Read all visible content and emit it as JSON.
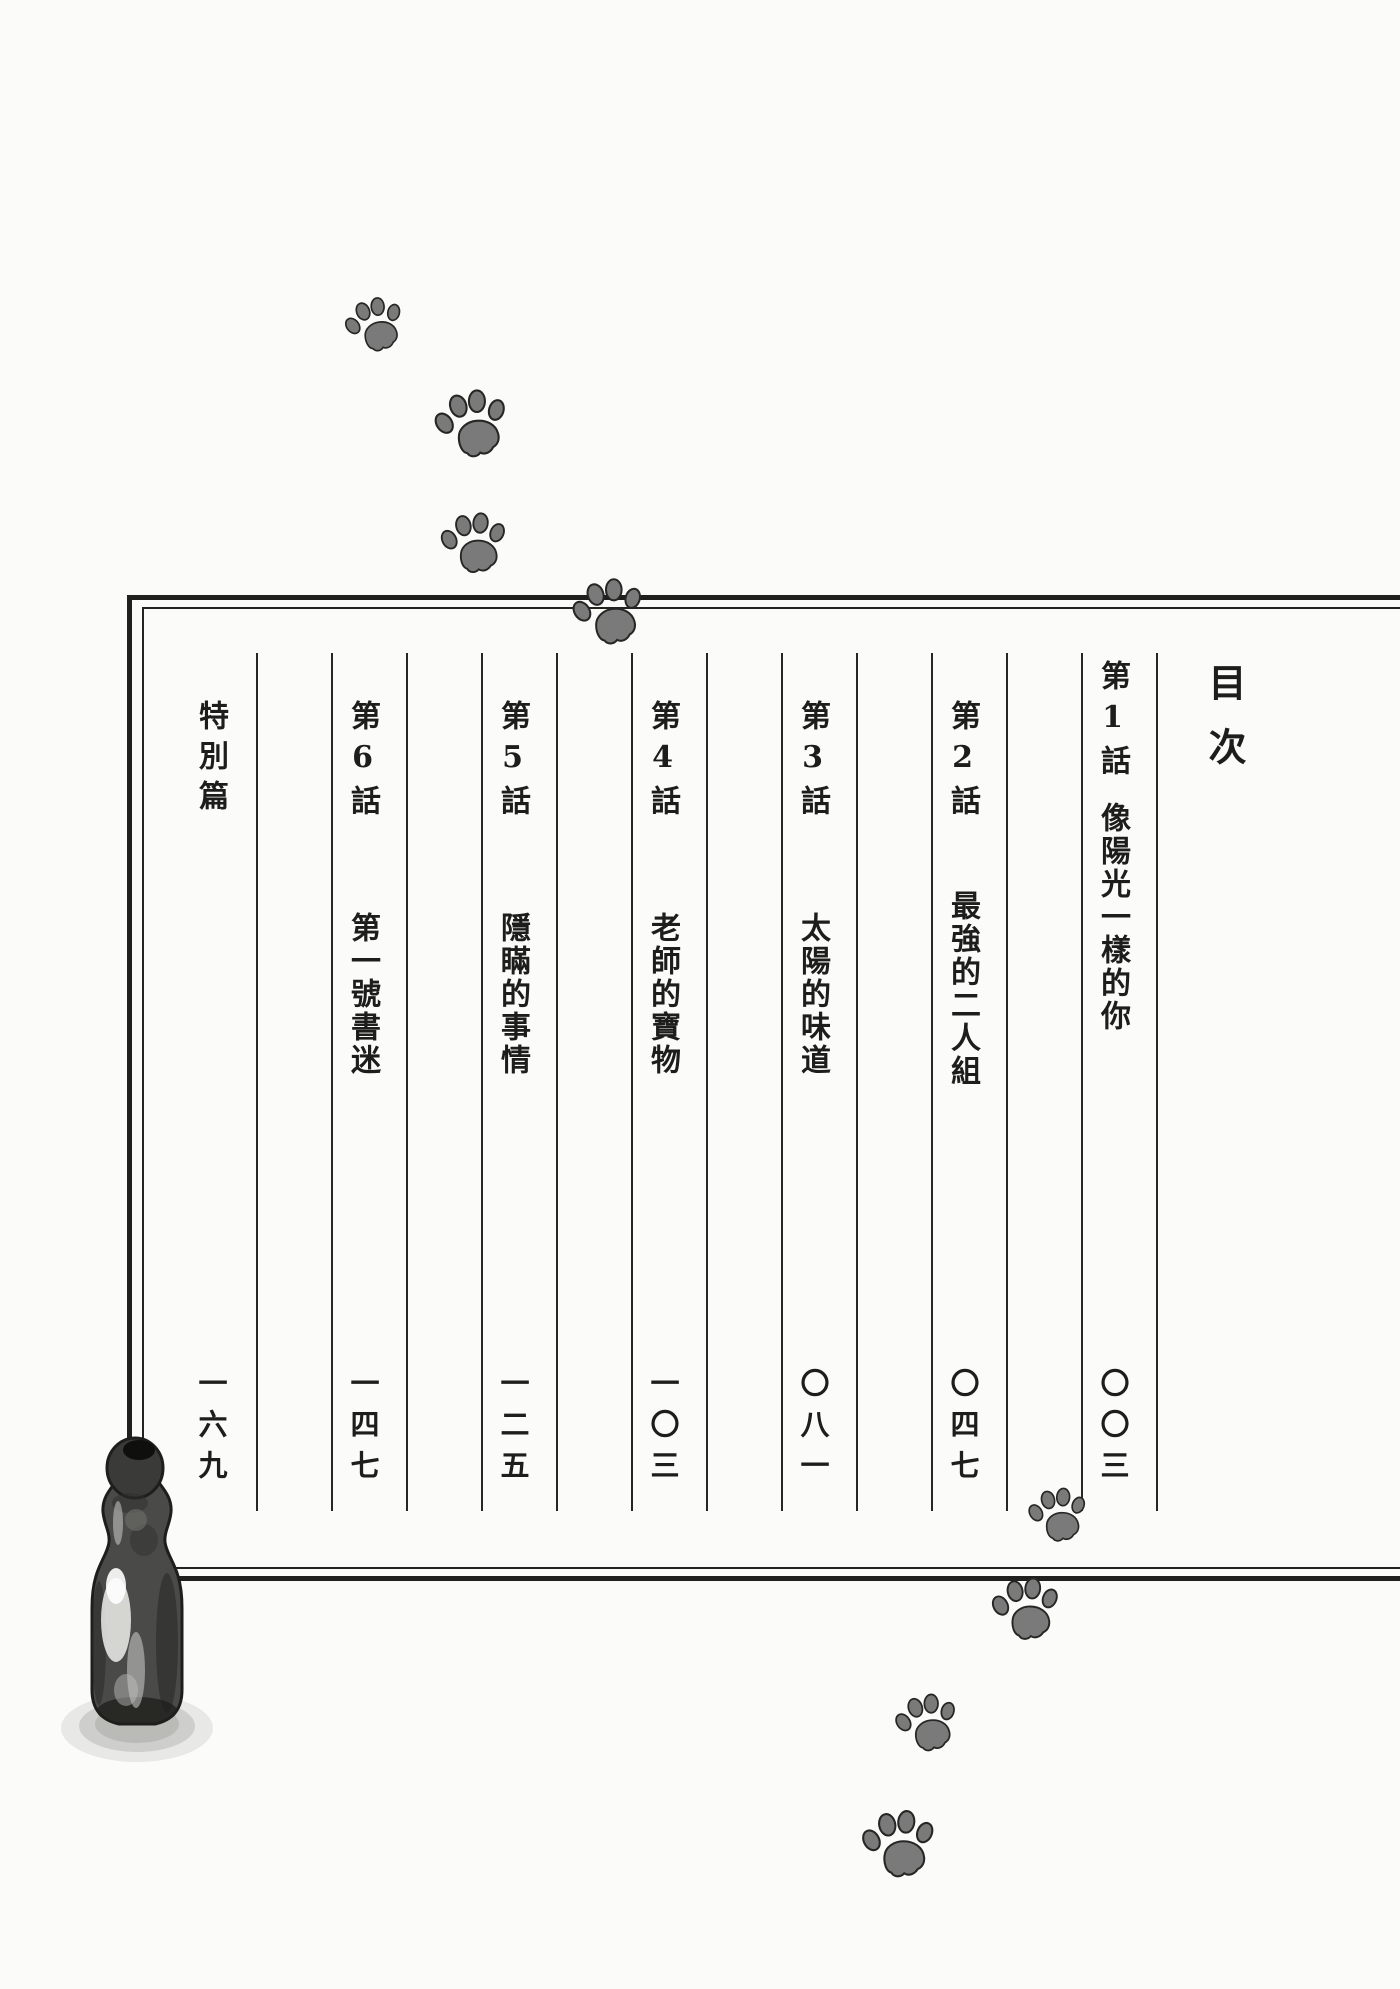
{
  "page_title": "目次",
  "toc": {
    "entries": [
      {
        "chapter": "第1話",
        "title": "像陽光一樣的你",
        "page_number": "〇〇三"
      },
      {
        "chapter": "第2話",
        "title": "最強的二人組",
        "page_number": "〇四七"
      },
      {
        "chapter": "第3話",
        "title": "太陽的味道",
        "page_number": "〇八一"
      },
      {
        "chapter": "第4話",
        "title": "老師的寶物",
        "page_number": "一〇三"
      },
      {
        "chapter": "第5話",
        "title": "隱瞞的事情",
        "page_number": "一二五"
      },
      {
        "chapter": "第6話",
        "title": "第一號書迷",
        "page_number": "一四七"
      },
      {
        "chapter": "特別篇",
        "title": "",
        "page_number": "一六九"
      }
    ]
  },
  "icons": {
    "paw_prints": "paw-print-icon",
    "bottle": "ramune-bottle-icon"
  },
  "colors": {
    "ink": "#1d1d1b",
    "paper": "#fbfbf9",
    "paw_fill": "#7a7a7a"
  }
}
